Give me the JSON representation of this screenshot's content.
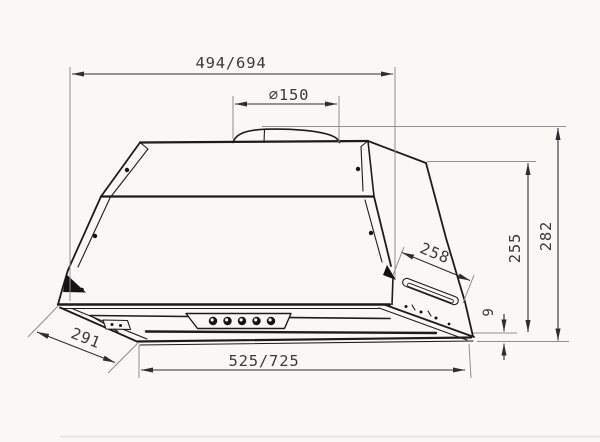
{
  "drawing": {
    "title": "built-in cooker hood dimensional drawing",
    "dimensions": {
      "top_width": "494/694",
      "duct_diameter": "⌀150",
      "body_depth": "258",
      "height_to_body": "255",
      "height_total": "282",
      "panel_lip": "9",
      "panel_depth": "291",
      "bottom_width": "525/725"
    },
    "colors": {
      "background": "#f9f8f5",
      "object_line": "#1c1c1c",
      "dimension_line": "#2e2e2e",
      "extension_line": "#8f8f8f",
      "text": "#3a3a3a"
    }
  }
}
